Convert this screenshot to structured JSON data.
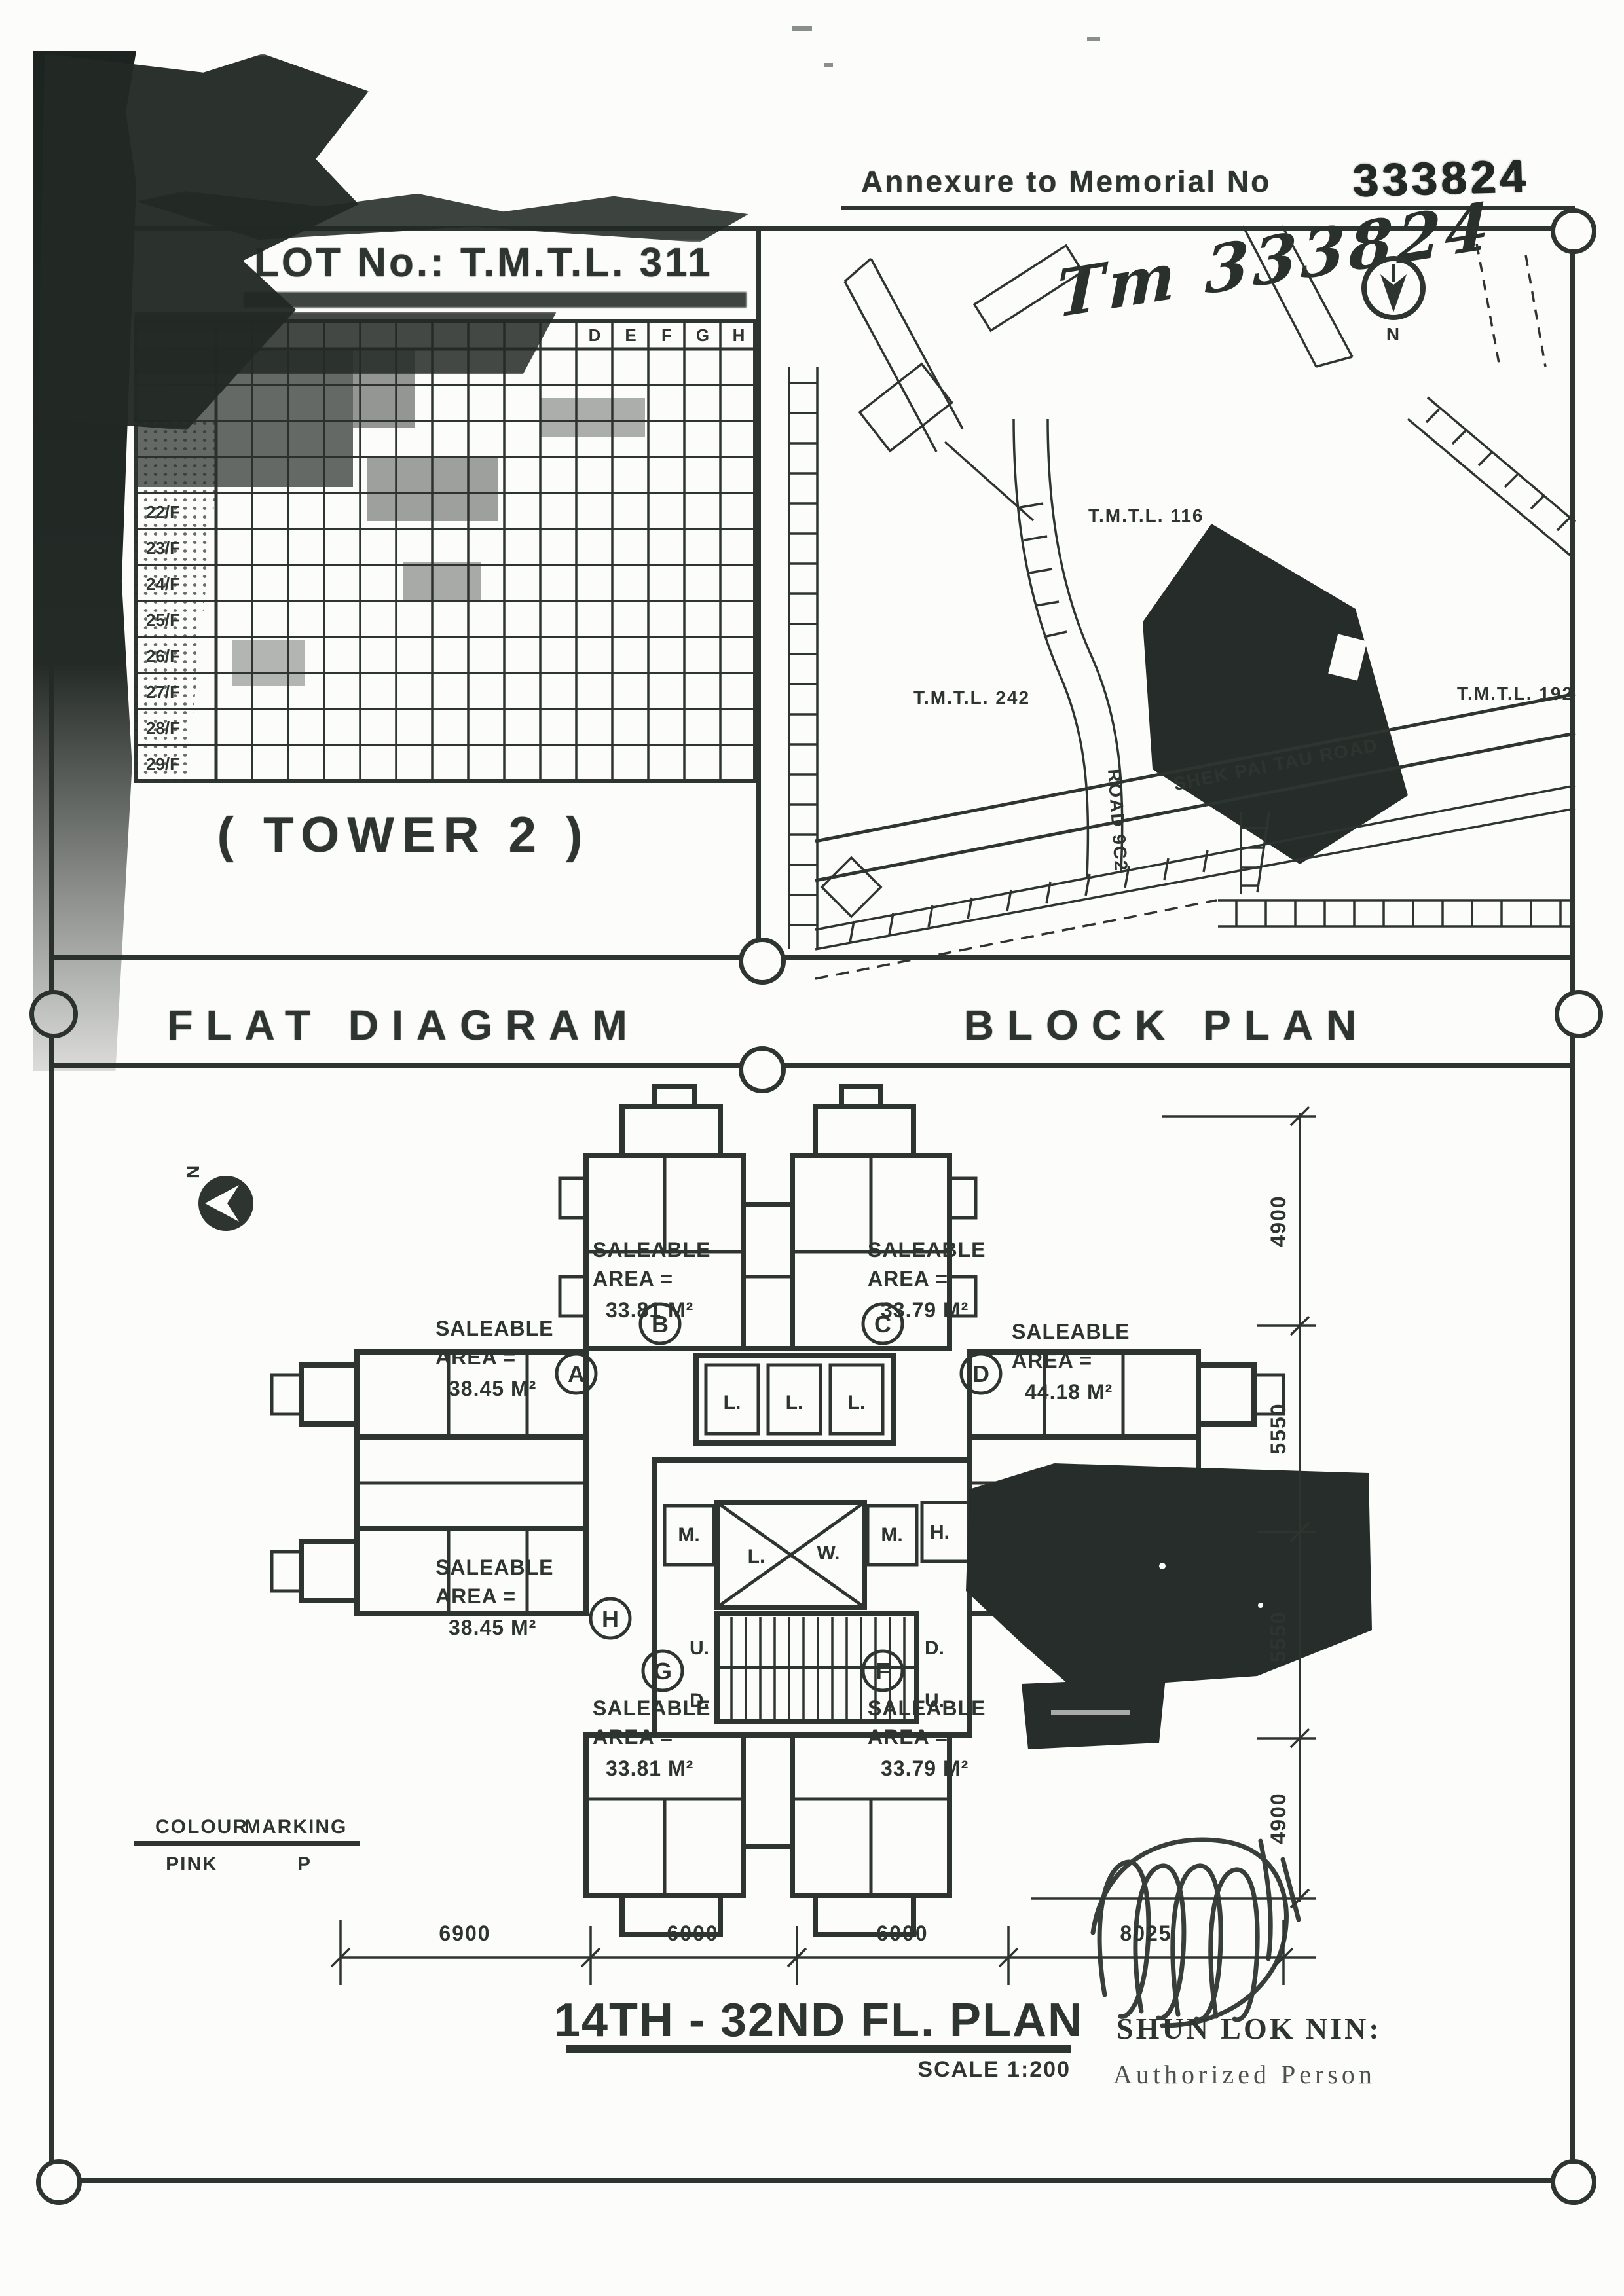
{
  "doc": {
    "annexure_label": "Annexure to Memorial No",
    "memorial_no_stamp": "333824",
    "memorial_no_handwritten": "Tm 333824",
    "ink_color": "#2e3531",
    "paper_color": "#fcfcfa"
  },
  "flat_table": {
    "title": "LOT No.: T.M.T.L. 311",
    "tower_label": "( TOWER  2 )",
    "visible_column_headers": [
      "D",
      "E",
      "F",
      "G",
      "H"
    ],
    "visible_floor_labels": [
      "22/F",
      "23/F",
      "24/F",
      "25/F",
      "26/F",
      "27/F",
      "28/F",
      "29/F"
    ]
  },
  "captions": {
    "left": "FLAT DIAGRAM",
    "right": "BLOCK PLAN"
  },
  "block_plan": {
    "north_label": "N",
    "lot_116": "T.M.T.L. 116",
    "lot_242": "T.M.T.L. 242",
    "lot_192": "T.M.T.L. 192",
    "road_9c2": "ROAD 9C2",
    "shek_pai_tau_road": "SHEK PAI TAU ROAD"
  },
  "flat_diagram": {
    "north_label": "N",
    "flats": [
      {
        "letter": "A",
        "lines": [
          "SALEABLE",
          "AREA =",
          "38.45 M²"
        ]
      },
      {
        "letter": "B",
        "lines": [
          "SALEABLE",
          "AREA =",
          "33.81 M²"
        ]
      },
      {
        "letter": "C",
        "lines": [
          "SALEABLE",
          "AREA =",
          "33.79 M²"
        ]
      },
      {
        "letter": "D",
        "lines": [
          "SALEABLE",
          "AREA =",
          "44.18 M²"
        ]
      },
      {
        "letter": "F",
        "lines": [
          "SALEABLE",
          "AREA =",
          "33.79 M²"
        ]
      },
      {
        "letter": "G",
        "lines": [
          "SALEABLE",
          "AREA =",
          "33.81 M²"
        ]
      },
      {
        "letter": "H",
        "lines": [
          "SALEABLE",
          "AREA =",
          "38.45 M²"
        ]
      }
    ],
    "core": {
      "lifts": [
        "L.",
        "L.",
        "L."
      ],
      "lightwell_l": "L.",
      "lightwell_w": "W.",
      "meter_left": "M.",
      "meter_right": "M.",
      "hose_room": "H.",
      "stair_up_1": "U.",
      "stair_down_1": "D.",
      "stair_down_2": "D.",
      "stair_up_2": "U."
    },
    "dims_right": [
      "4900",
      "5550",
      "5550",
      "4900"
    ],
    "dims_bottom": [
      "6900",
      "6000",
      "6000",
      "8025"
    ],
    "legend": {
      "colour": "COLOUR",
      "marking": "MARKING",
      "pink": "PINK",
      "p": "P"
    },
    "title": "14TH - 32ND FL. PLAN",
    "scale": "SCALE 1:200",
    "signature": {
      "name": "SHUN LOK NIN:",
      "role": "Authorized Person"
    }
  }
}
